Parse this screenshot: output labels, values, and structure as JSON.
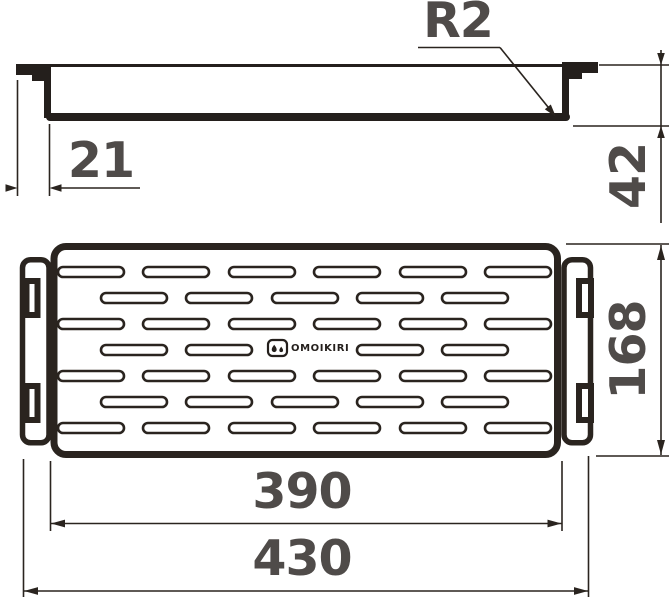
{
  "side_view": {
    "radius_label": "R2",
    "edge_offset_label": "21",
    "height_label": "42"
  },
  "top_view": {
    "depth_label": "168",
    "inner_width_label": "390",
    "outer_width_label": "430",
    "brand": "OMOIKIRI"
  },
  "colors": {
    "line": "#241f1c",
    "dimension_text": "#4f4b49",
    "background": "#ffffff"
  },
  "strainer": {
    "slot": {
      "w": 66,
      "h": 10,
      "rx": 5
    },
    "rows": [
      {
        "y": 267,
        "starts": [
          58,
          143,
          229,
          314,
          400,
          485
        ]
      },
      {
        "y": 293,
        "starts": [
          101,
          186,
          272,
          357,
          442
        ]
      },
      {
        "y": 319,
        "starts": [
          58,
          143,
          229,
          314,
          400,
          485
        ]
      },
      {
        "y": 345,
        "starts": [
          101,
          186,
          357,
          442
        ]
      },
      {
        "y": 371,
        "starts": [
          58,
          143,
          229,
          314,
          400,
          485
        ]
      },
      {
        "y": 397,
        "starts": [
          101,
          186,
          272,
          357,
          442
        ]
      },
      {
        "y": 423,
        "starts": [
          58,
          143,
          229,
          314,
          400,
          485
        ]
      }
    ]
  }
}
